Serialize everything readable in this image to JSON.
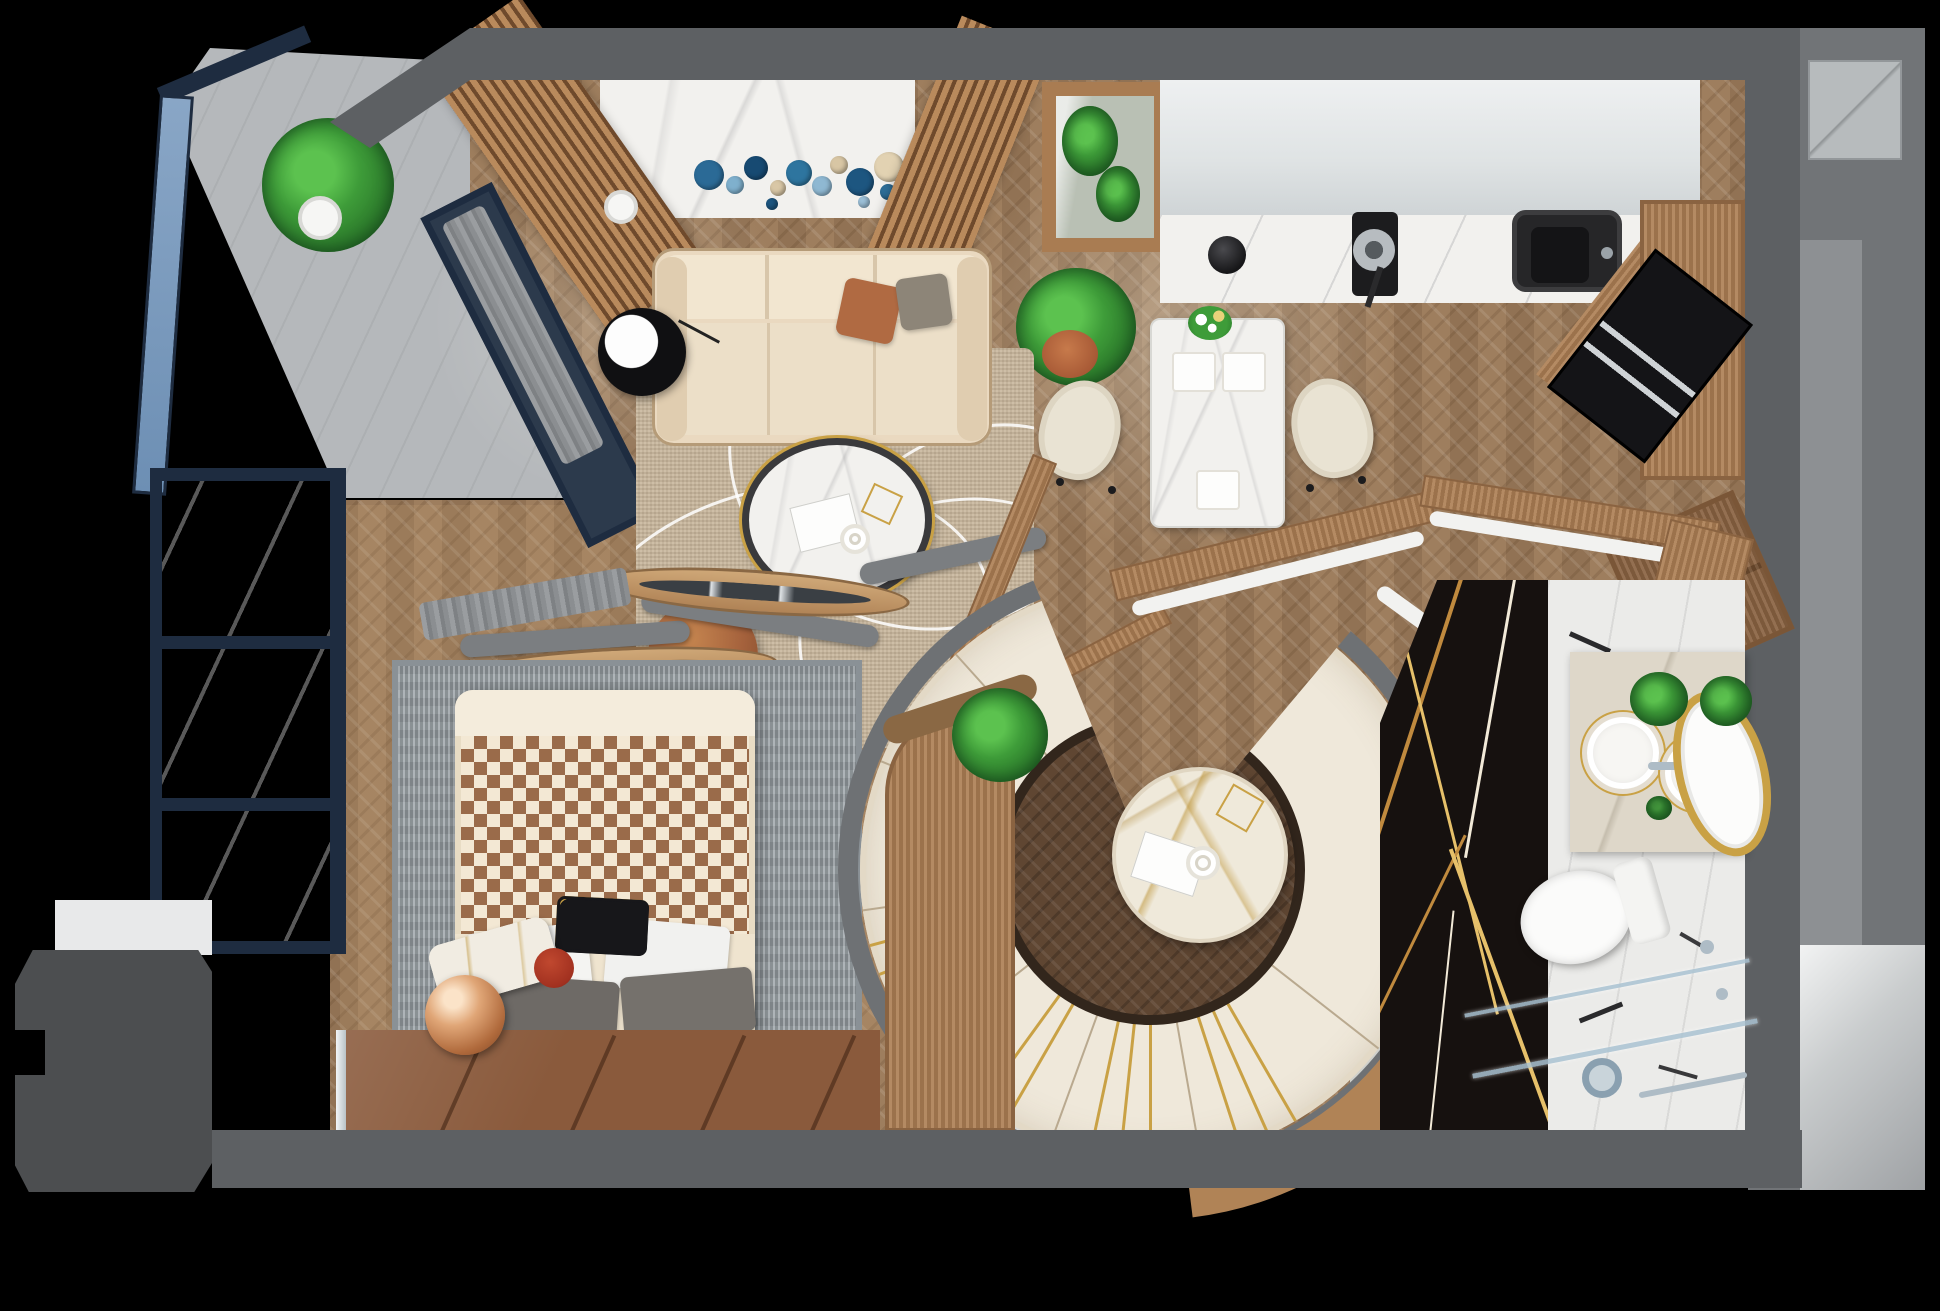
{
  "scene": {
    "type": "apartment-floor-plan-3d-top-down-render",
    "style": "photorealistic interior visualization, no text labels",
    "rooms": [
      "balcony-upper",
      "living-room",
      "kitchen-dining",
      "bedroom",
      "balcony-lower",
      "spiral-lounge",
      "bathroom",
      "hall"
    ]
  },
  "palette": {
    "wall": "#5d6063",
    "wall_dark": "#4c4e50",
    "navy": "#1e2c40",
    "glass": "#7e9cc0",
    "floor": "#9b7c5d",
    "wood": "#ad7f54",
    "marble": "#f2f1ee",
    "cream": "#ead9c0",
    "cream2": "#efe8da",
    "rug": "#c7b59b",
    "gold": "#c9a145",
    "rust": "#b06a42",
    "leather": "#8a5a3c",
    "black_marble": "#16110f",
    "green": "#3e9c39",
    "terracotta": "#a85a36"
  },
  "inventory": {
    "living_room": [
      "3-seat cream sofa",
      "rust pillow",
      "gray pillow",
      "black floor lamp",
      "oval marble coffee table",
      "book",
      "cup",
      "gold wire decor",
      "brown leather pouf",
      "beige rug with white swirls",
      "blue wall plates decor",
      "wood slat partitions",
      "gray curtain",
      "white vase"
    ],
    "kitchen_dining": [
      "white marble counter",
      "black kettle",
      "induction cooktop with pan",
      "black sink",
      "tall wood cabinet",
      "built-in black oven",
      "wood chest with gold key",
      "marble dining table",
      "3 place settings",
      "flower vase",
      "2 cream chairs",
      "framed mirror with plants",
      "potted plant"
    ],
    "bedroom": [
      "double bed",
      "patterned blanket",
      "5 pillows",
      "gray rug",
      "brown leather platform",
      "copper sphere lamp",
      "marble cylinder side table with red top",
      "gray curtain",
      "panorama window"
    ],
    "spiral_lounge": [
      "curved banquette sofa with gold stripes",
      "round marble table",
      "magazine",
      "coffee cup",
      "gold wire basket",
      "curved wood console",
      "plant",
      "curved shelf with decor"
    ],
    "bathroom": [
      "black-gold marble wall",
      "marble floor",
      "double round sinks",
      "gold oval mirror",
      "two plants",
      "wall-hung toilet",
      "glass shower",
      "drain",
      "chrome fittings"
    ],
    "balcony": [
      "blue glass railing",
      "fiddle-leaf plant",
      "white pot",
      "gray deck"
    ]
  },
  "decor": {
    "wall_plates": [
      {
        "s": "left:694px;top:160px;width:30px;height:30px;background:#2b6a96"
      },
      {
        "s": "left:726px;top:176px;width:18px;height:18px;background:#7fb0cd"
      },
      {
        "s": "left:744px;top:156px;width:24px;height:24px;background:#174a72"
      },
      {
        "s": "left:770px;top:180px;width:16px;height:16px;background:#d9c7a6"
      },
      {
        "s": "left:786px;top:160px;width:26px;height:26px;background:#2e759f"
      },
      {
        "s": "left:812px;top:176px;width:20px;height:20px;background:#8fb8d2"
      },
      {
        "s": "left:830px;top:156px;width:18px;height:18px;background:#d8c6a4"
      },
      {
        "s": "left:846px;top:168px;width:28px;height:28px;background:#1d5680"
      },
      {
        "s": "left:874px;top:152px;width:30px;height:30px;background:#e2d2b2"
      },
      {
        "s": "left:880px;top:184px;width:16px;height:16px;background:#2e6f99"
      },
      {
        "s": "left:858px;top:196px;width:12px;height:12px;background:#9cc0d8"
      },
      {
        "s": "left:766px;top:198px;width:12px;height:12px;background:#1d5680"
      }
    ],
    "rug_swirls": [
      {
        "s": "left:-70px;top:140px;width:430px;height:300px;transform:rotate(-15deg)"
      },
      {
        "s": "left:90px;top:-50px;width:380px;height:330px;transform:rotate(18deg)"
      },
      {
        "s": "left:30px;top:180px;width:440px;height:260px;transform:rotate(-32deg)"
      },
      {
        "s": "left:180px;top:60px;width:300px;height:380px;transform:rotate(40deg)"
      }
    ],
    "place_settings": [
      {
        "s": "left:20px;top:32px;width:44px;height:40px"
      },
      {
        "s": "left:70px;top:32px;width:44px;height:40px"
      },
      {
        "s": "left:44px;top:150px;width:44px;height:40px"
      }
    ],
    "ring_gold_stripes": [
      150,
      156,
      162,
      180,
      186,
      192,
      210,
      216,
      243,
      249,
      255
    ],
    "ring_seams": [
      128,
      170,
      200,
      232,
      262,
      292,
      318
    ],
    "shelf_items": [
      {
        "s": "left:1398px;top:668px;width:34px;height:30px;border-radius:50%;background:#f4f4f2;box-shadow:inset 0 0 0 4px #d8d8d4,14px 6px 0 -6px #fff"
      },
      {
        "s": "left:1436px;top:742px;width:34px;height:34px;border-radius:50%;background:radial-gradient(circle at 40% 40%,#5cc24f,#2c7a2b)"
      },
      {
        "s": "left:1442px;top:820px;width:44px;height:52px;background:#f6f4ee;border:2px solid #d8d4c8;box-shadow:inset 0 0 0 10px rgba(40,40,42,.0);"
      },
      {
        "s": "left:1452px;top:832px;width:28px;height:28px;border-radius:50%;background:#2c2c30"
      },
      {
        "s": "left:1432px;top:906px;width:40px;height:18px;transform:rotate(-30deg);background:#a32218;border-radius:6px"
      },
      {
        "s": "left:1420px;top:962px;width:24px;height:24px;border-radius:50%;background:radial-gradient(circle at 40% 40%,#59c24f,#2c7a2b);box-shadow:10px 8px 0 -4px #c0392b"
      }
    ],
    "black_marble_veins": [
      {
        "s": "left:30px;top:-10px;width:4px;height:320px;transform:rotate(18deg);background:#c08a3e"
      },
      {
        "s": "left:70px;top:60px;width:3px;height:380px;transform:rotate(-14deg);background:#e6c06a"
      },
      {
        "s": "left:110px;top:-20px;width:3px;height:300px;transform:rotate(10deg);background:#f2ead8"
      },
      {
        "s": "left:18px;top:240px;width:3px;height:300px;transform:rotate(26deg);background:#c08a3e"
      },
      {
        "s": "left:120px;top:260px;width:4px;height:300px;transform:rotate(-20deg);background:#e6c06a"
      },
      {
        "s": "left:60px;top:330px;width:2px;height:240px;transform:rotate(6deg);background:#f2ead8"
      }
    ],
    "bath_streaks": [
      {
        "s": "left:20px;top:60px;width:44px;height:5px;transform:rotate(24deg);background:#2a2a2c"
      },
      {
        "s": "left:120px;top:140px;width:36px;height:4px;transform:rotate(-18deg);background:#3a3a3c"
      },
      {
        "s": "left:50px;top:260px;width:50px;height:5px;transform:rotate(12deg);background:#2a2a2c"
      },
      {
        "s": "left:130px;top:360px;width:34px;height:4px;transform:rotate(30deg);background:#3a3a3c"
      },
      {
        "s": "left:30px;top:430px;width:46px;height:5px;transform:rotate(-22deg);background:#2a2a2c"
      },
      {
        "s": "left:110px;top:490px;width:40px;height:4px;transform:rotate(16deg);background:#38383a"
      }
    ],
    "window_bars": [
      {
        "s": "top:0px"
      },
      {
        "s": "top:168px"
      },
      {
        "s": "top:330px"
      },
      {
        "s": "top:473px"
      }
    ],
    "leather_seams": [
      {
        "s": "left:120px"
      },
      {
        "s": "left:250px"
      },
      {
        "s": "left:380px"
      },
      {
        "s": "left:490px"
      }
    ],
    "light_pools": [
      {
        "s": "left:950px;top:130px;width:460px;height:420px;background:radial-gradient(circle,rgba(255,252,240,.30),transparent 70%)"
      },
      {
        "s": "left:420px;top:150px;width:380px;height:340px;background:radial-gradient(circle,rgba(255,252,240,.22),transparent 70%)"
      },
      {
        "s": "left:1080px;top:820px;width:340px;height:300px;background:radial-gradient(circle,rgba(255,250,235,.18),transparent 70%)"
      },
      {
        "s": "left:500px;top:820px;width:320px;height:280px;background:radial-gradient(circle,rgba(255,250,235,.14),transparent 70%)"
      }
    ]
  }
}
